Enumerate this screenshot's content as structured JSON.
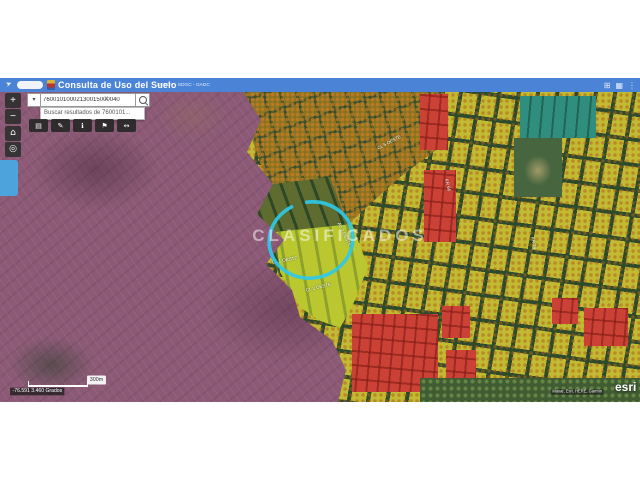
{
  "header": {
    "title": "Consulta de Uso del Suelo",
    "links": "SEPOV - SDGC - GADC"
  },
  "header_icons": {
    "nav": "➤",
    "grid": "⊞",
    "apps": "▦",
    "menu": "⋮"
  },
  "search": {
    "value": "76001010002130015000040",
    "suggestion": "Buscar resultados de 7600101...",
    "clear_icon": "×",
    "dropdown_icon": "▾"
  },
  "toolbar": {
    "zoom_in": "+",
    "zoom_out": "−",
    "home_icon": "⌂",
    "locate_icon": "◎",
    "tool_icons": {
      "print": "▤",
      "draw": "✎",
      "info": "ℹ",
      "bookmark": "⚑",
      "measure": "↔"
    }
  },
  "map": {
    "watermark": "CLASIFICADOS",
    "street_labels": [
      "CL 1 OESTE",
      "CL 2 OESTE",
      "AV 2 OESTE",
      "KR 66",
      "CL 5 OESTE",
      "KR 24"
    ],
    "scale_label": "300m",
    "coordinates": "-76.591 3.460 Grados",
    "attribution": "Maxar, Esri, HERE, Garmin",
    "esri_logo": "esri"
  },
  "colors": {
    "header_blue": "#4b84d6",
    "circle_cyan": "#2ec9e8",
    "zone_yellow": "#c3ba33",
    "zone_olive": "#857322",
    "zone_purple": "#8c5a76",
    "zone_red": "#cb4136",
    "zone_teal": "#2f8e7e",
    "zone_park": "#47663f",
    "zone_bright": "#bac72f",
    "street_green": "#2c4a2c",
    "panel_blue": "#4da3dc"
  }
}
